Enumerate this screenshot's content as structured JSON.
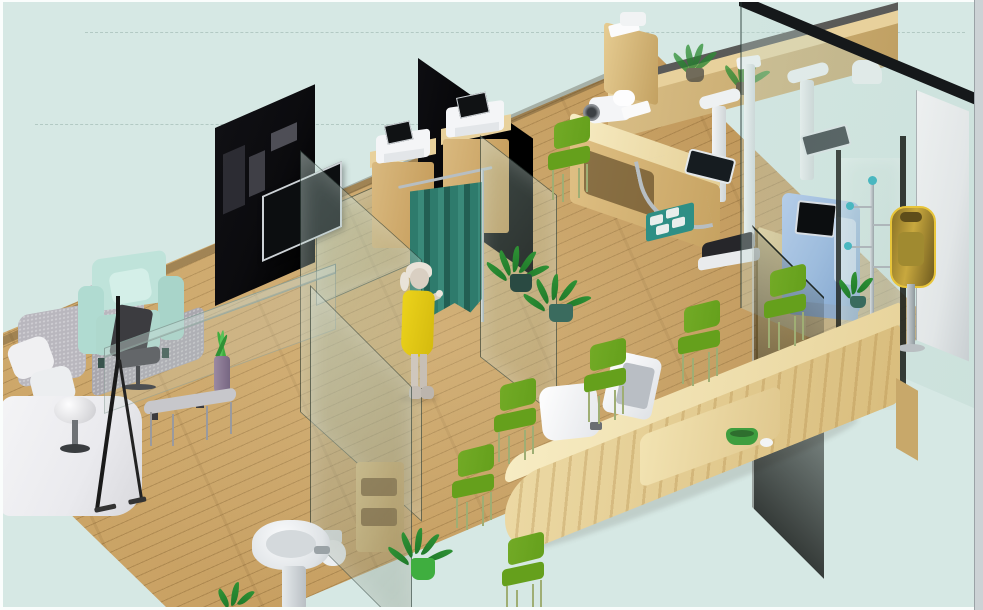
{
  "scene": {
    "type": "isometric-3d-interior-render",
    "room": "clinic-health-check-interior",
    "visible_text": [],
    "objects": [
      {
        "name": "wood-plank-floor",
        "color": "#cfa96b"
      },
      {
        "name": "glass-facade-wall",
        "color": "rgba(210,232,226,0.5)"
      },
      {
        "name": "dark-wardrobe-panel",
        "color": "#0b0b0e"
      },
      {
        "name": "wall-tv",
        "color": "#0c0e10"
      },
      {
        "name": "privacy-curtain",
        "color": "#2e7b6c"
      },
      {
        "name": "exam-cabinet",
        "color": "#d2b075"
      },
      {
        "name": "ecg-device",
        "color": "#f4f5f7"
      },
      {
        "name": "standing-woman-yellow-dress",
        "color": "#ecd31c"
      },
      {
        "name": "potted-plant",
        "color": "#2f9235"
      },
      {
        "name": "measurement-desk",
        "color": "#d9b878"
      },
      {
        "name": "blood-pressure-monitor",
        "color": "#f4f5f7"
      },
      {
        "name": "weighing-scale",
        "color": "#26262a"
      },
      {
        "name": "height-rod",
        "color": "#eef0f2"
      },
      {
        "name": "teal-floor-mat",
        "color": "#2e8f85"
      },
      {
        "name": "checkin-kiosk-blue",
        "color": "#9dbcdd"
      },
      {
        "name": "coat-rack",
        "color": "#b7bec2"
      },
      {
        "name": "gold-wall-dispenser",
        "color": "#c8a83e"
      },
      {
        "name": "entrance-glass-door",
        "color": "#1c201c"
      },
      {
        "name": "reception-counter",
        "color": "#ecd9a4"
      },
      {
        "name": "reception-monitor",
        "color": "#f5f6f8"
      },
      {
        "name": "waiting-chair-green",
        "color": "#72aa26"
      },
      {
        "name": "sofa-gray",
        "color": "#b9b7be"
      },
      {
        "name": "armchair-mint",
        "color": "#bfe3da"
      },
      {
        "name": "glass-coffee-table",
        "color": "rgba(190,205,200,0.3)"
      },
      {
        "name": "mushroom-lamp",
        "color": "#fbfbfc"
      },
      {
        "name": "easel-stand",
        "color": "#151515"
      },
      {
        "name": "pedestal-sink",
        "color": "#f2f4f6"
      },
      {
        "name": "toilet",
        "color": "#eceff1"
      },
      {
        "name": "bathroom-shelf",
        "color": "#d2b075"
      },
      {
        "name": "glass-partition",
        "color": "rgba(182,212,203,0.35)"
      },
      {
        "name": "green-serving-bowl",
        "color": "#3f9e3f"
      },
      {
        "name": "entry-gate-post",
        "color": "#f0f2f3"
      }
    ]
  },
  "palette": {
    "bg": "#d6e8e4",
    "frame_light": "#fafdfc",
    "frame_gray": "#ccd2d5",
    "wood": "#cfa96b",
    "wood_dark": "#bb9154",
    "wood_light": "#e8d19c",
    "counter": "#ecd9a4",
    "counter_hi": "#f7ecc3",
    "dark_panel": "#0b0b0e",
    "glass_tint": "rgba(182,212,203,0.35)",
    "glass_edge": "rgba(30,45,40,0.55)",
    "facade_haze": "rgba(228,242,238,0.5)",
    "curtain": "#2e7b6c",
    "curtain_d": "#225f53",
    "chair": "#72aa26",
    "chair_d": "#65a01c",
    "leg": "#9fae74",
    "mint": "#bfe3da",
    "mint_d": "#a8d4c9",
    "sofa_gray": "#b9b7be",
    "sofa_gray_d": "#a9a7ae",
    "sofa_white": "#eaeaee",
    "dress": "#ecd31c",
    "skin": "#d9cfc2",
    "hair": "#e9e3d9",
    "machine_blue": "#9dbcdd",
    "machine_blue_d": "#7fa3cc",
    "gold": "#c8a83e",
    "gold_d": "#7a6424",
    "plant": "#2f9235",
    "plant_d": "#1f7a2a",
    "plant_teal_pot": "#2a4a42",
    "mat": "#2e8f85",
    "scale_black": "#26262a",
    "chrome": "#b7bec2",
    "white_dev": "#f4f5f7",
    "screen": "#0c0e10",
    "tv_frame": "#cdd2d6",
    "wall_white": "#e2e6e7"
  }
}
